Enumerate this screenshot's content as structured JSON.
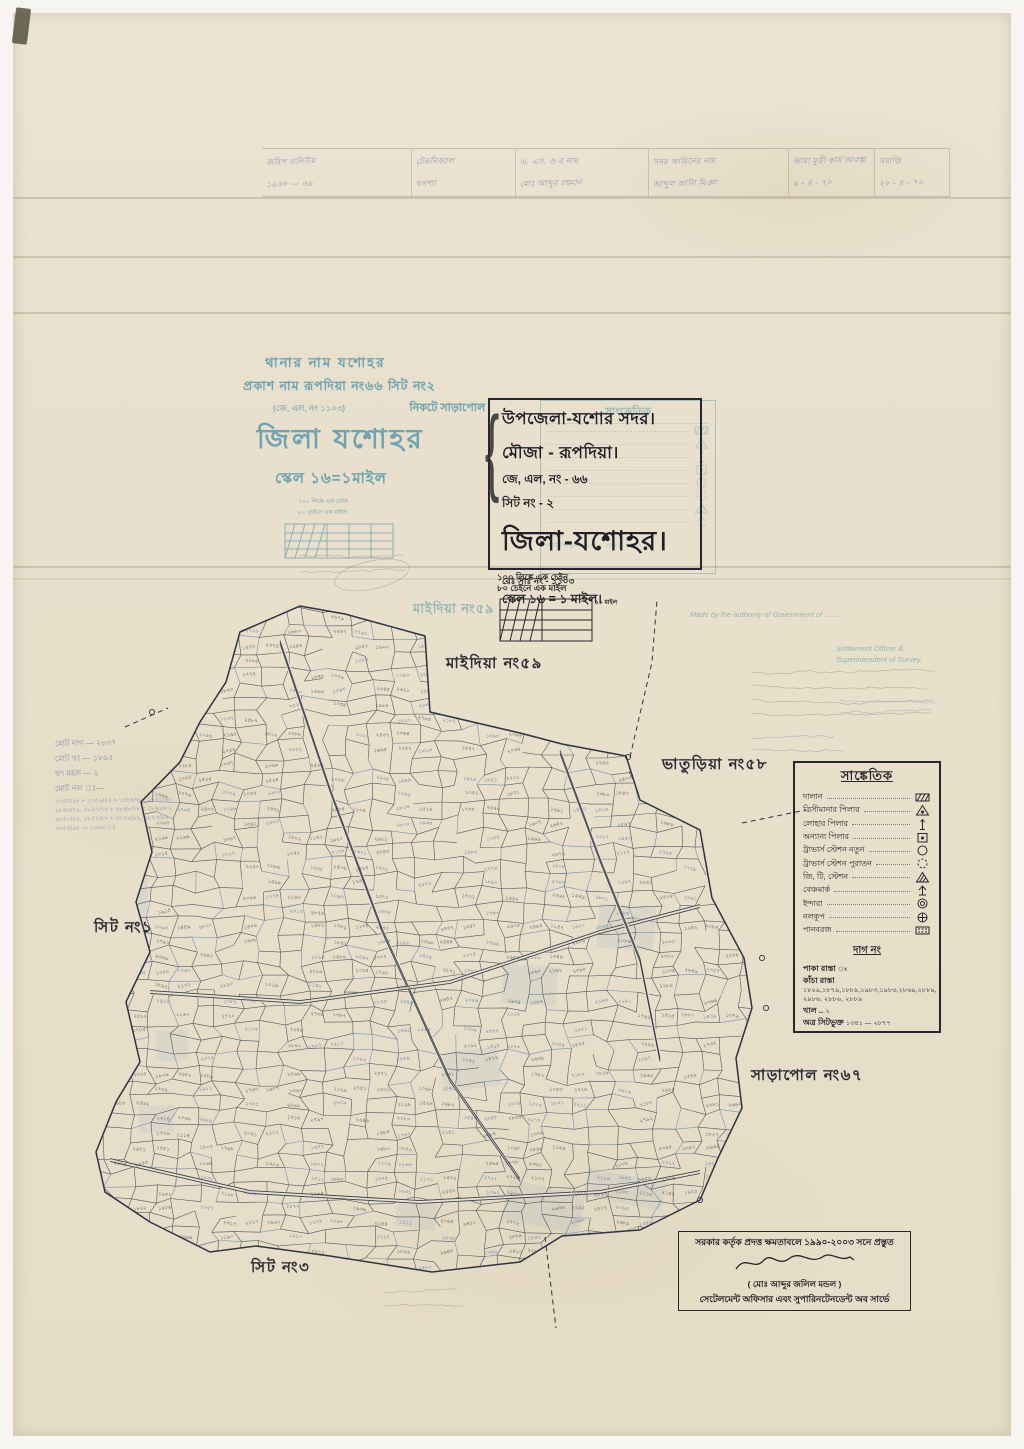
{
  "colors": {
    "paper": "#e9e1cd",
    "ink": "#26262c",
    "stamp_teal": "#4e93aa",
    "hand_blue": "#4a62a8",
    "map_ink": "#39404f",
    "map_blue": "#4a6fae"
  },
  "header_table": {
    "columns": [
      {
        "lines": [
          "জরিপ ভলিউম",
          "১৯৬৮ — ৬৯"
        ]
      },
      {
        "lines": [
          "টেকনিক্যাল",
          "ঘনশ্যা"
        ]
      },
      {
        "lines": [
          "এ. এস. ও-র নাম",
          "মোঃ আব্দুর রহমান"
        ]
      },
      {
        "lines": [
          "সদর আমিনের নাম",
          "আব্দুল আলি মিঞা"
        ]
      },
      {
        "lines": [
          "আমা মুড়ী কার্য আরম্ভ",
          "৯ - ৪ - ৭০"
        ]
      },
      {
        "lines": [
          "সমাপ্তি",
          "২৮ - ৪ - ৭০"
        ]
      }
    ]
  },
  "blue_stamp": {
    "line1": "থানার নাম যশোহর",
    "line2": "প্রকাশ নাম রূপদিয়া নং৬৬ সিট নং২",
    "line3a": "(জে, এল, নং ১১০৩)",
    "line3b": "নিকটে সাড়াপোল",
    "title": "জিলা যশোহর",
    "scale": "স্কেল ১৬=১মাইল",
    "note1": "১০০ লিঙ্কে এক চেইন",
    "note2": "৮০ চেইনে এক মাইল"
  },
  "ghost_legend": {
    "title": "সাংকেতিক",
    "foot1": "দাগ নং",
    "foot2": "অত্র সিটভুক্ত ১৩৪১ - ২৮৪১, ২৮৪২"
  },
  "title_block": {
    "upazila": "উপজেলা-যশোর সদর।",
    "mouza": "মৌজা - রূপদিয়া।",
    "jl_no": "জে, এল, নং - ৬৬",
    "sheet_no": "সিট নং - ২",
    "district": "জিলা-যশোহর।",
    "reg_no": "রেঃ সাঃ নং - ১১০৩",
    "scale": "স্কেল ১৬ = ১ মাইল।",
    "brace": "{"
  },
  "scale_note": {
    "line1": "১০০ লিঙ্কে এক চেইন",
    "line2": "৮০ চেইনে এক মাইল",
    "right_label": "১০ মাইল"
  },
  "map_labels": [
    {
      "text": "মাইদিয়া নং৫৯",
      "x": 413,
      "y": 600,
      "style": "blue"
    },
    {
      "text": "মাইদিয়া নং৫৯",
      "x": 446,
      "y": 652,
      "style": "black"
    },
    {
      "text": "ভাতুড়িয়া নং৫৮",
      "x": 662,
      "y": 753,
      "style": "black"
    },
    {
      "text": "সিট নং১",
      "x": 94,
      "y": 916,
      "style": "black"
    },
    {
      "text": "সাড়াপোল নং৬৭",
      "x": 751,
      "y": 1064,
      "style": "black"
    },
    {
      "text": "সিট নং৩",
      "x": 251,
      "y": 1256,
      "style": "black"
    }
  ],
  "legend": {
    "title": "সাঙ্কেতিক",
    "items": [
      {
        "label": "দালান",
        "symbol": "building"
      },
      {
        "label": "ত্রিসীমানার পিলার",
        "symbol": "triangle-dot"
      },
      {
        "label": "লোহার পিলার",
        "symbol": "iron-pillar"
      },
      {
        "label": "অন্যান্য পিলার",
        "symbol": "square-dot"
      },
      {
        "label": "ট্রাভার্স স্টেশন নতুন",
        "symbol": "circle"
      },
      {
        "label": "ট্রাভার্স স্টেশন পুরাতন",
        "symbol": "dashed-circle"
      },
      {
        "label": "জি, টি, স্টেশন",
        "symbol": "hatched-triangle"
      },
      {
        "label": "বেঞ্চমার্ক",
        "symbol": "benchmark"
      },
      {
        "label": "ইন্দারা",
        "symbol": "double-circle"
      },
      {
        "label": "নলকূপ",
        "symbol": "circle-cross"
      },
      {
        "label": "পানবরজ",
        "symbol": "pan-borj"
      }
    ]
  },
  "plot_section": {
    "header": "দাগ নং",
    "rows": [
      {
        "label": "পাকা রাস্তা",
        "value": "ঃ"
      },
      {
        "label": "কাঁচা রাস্তা",
        "value": "১৮০৯,১৮৭৯,১৮৮৯,১৯৮৩,১৯৮৬,২৮৬৯,২৮৮৯, ২৯৮৬, ২৮৮৬, ২৮৮৯"
      },
      {
        "label": "খাল ..",
        "value": "২"
      },
      {
        "label": "অত্র সিটভুক্ত",
        "value": "১৩৪১ — ২৮৭৭"
      }
    ],
    "bata_label": "বাটা দাগ ঃ",
    "bata_numbers": "১৩৪৫/২৮৪২, ১৩৫৭/২৮৪৩, ১৩৬৯/২৮৪৪, ১৩৭৫/২৮৪৫, ১৪৮৩/২৮৪৬, ১৫৯৭/২৮৪৭, ১৬০৫/২৮৪৮, ১৬৪৯/২৮৪৯, ১৭৫৩/২৮৫০, ১৭৬৯/২৮৫১, ১৮৪৫/২৮৫২, ১৮৯৩/২৮৫৩, ১৯৪৭/২৮৫৪, ১৯৬৫/২৮৫৫, ২০৪৩/২৮৫৬, ২১৪৫/২৮৫৭, ২২৬৩/২৮৫৮, ২৩৪৯/২৮৫৯, ২৪৫৩/২৮৬০, ২৫৪৭/২৮৬১, ২৬৪৫/২৮৬২, ২৭৪৯/২৮৬৩ ঃ"
  },
  "signature_block": {
    "line1": "সরকার কর্তৃক প্রদত্ত ক্ষমতাবলে ১৯৯০-২০০৩ সনে প্রস্তুত",
    "name": "( মোঃ আব্দুর জলিল মন্ডল )",
    "line3": "সেটেলমেন্ট অফিসার এবং সুপারিনটেনডেন্ট অব সার্ভে"
  },
  "english_stamps": {
    "line1": "Made by the authority of Government of ........",
    "line2": "Settlement Officer &",
    "line3": "Superintendent of Survey"
  },
  "side_notes": {
    "lines": [
      "মোট দাগ — ২৮৩৭",
      "মোট খং — ১৮৯৫",
      "হুদ মহল — ২",
      "মোট নল ঃ—"
    ],
    "fractions": [
      "১৩৪৫/২৮ + ১৩৫৬/৪২ = ১৩৮৮/৬৫, ২৮৪৫/৬৮",
      "২৮৪৬/৭২, ২৮৪৭/৭৫ + ২৮৪৮/৭৮ = ২৮৪৯/৮২",
      "২৮৫০/৮৫, ২৮৫১/৮৮ + ২৮৫২/৯২, ২৮৫৩/৯৫",
      "২৮৫৪/৯৮ — ১০৬৬ ঃ"
    ]
  },
  "map": {
    "x0": 86,
    "y0": 594,
    "x1": 766,
    "y1": 1274,
    "cols": 31,
    "rows": 46,
    "number_min": 1000,
    "number_max": 2890,
    "boundary": [
      [
        240,
        632
      ],
      [
        300,
        606
      ],
      [
        345,
        614
      ],
      [
        425,
        636
      ],
      [
        430,
        712
      ],
      [
        520,
        733
      ],
      [
        562,
        744
      ],
      [
        626,
        756
      ],
      [
        640,
        800
      ],
      [
        700,
        830
      ],
      [
        712,
        898
      ],
      [
        744,
        958
      ],
      [
        752,
        1008
      ],
      [
        736,
        1058
      ],
      [
        742,
        1108
      ],
      [
        718,
        1158
      ],
      [
        700,
        1200
      ],
      [
        640,
        1230
      ],
      [
        562,
        1236
      ],
      [
        520,
        1262
      ],
      [
        432,
        1272
      ],
      [
        330,
        1256
      ],
      [
        256,
        1246
      ],
      [
        210,
        1252
      ],
      [
        150,
        1222
      ],
      [
        105,
        1192
      ],
      [
        96,
        1152
      ],
      [
        116,
        1102
      ],
      [
        140,
        1062
      ],
      [
        126,
        1002
      ],
      [
        150,
        952
      ],
      [
        136,
        902
      ],
      [
        152,
        852
      ],
      [
        141,
        802
      ],
      [
        180,
        762
      ],
      [
        200,
        722
      ],
      [
        226,
        682
      ]
    ],
    "roads": [
      [
        [
          280,
          642
        ],
        [
          330,
          790
        ],
        [
          382,
          930
        ],
        [
          450,
          1080
        ],
        [
          520,
          1180
        ]
      ],
      [
        [
          110,
          1160
        ],
        [
          250,
          1192
        ],
        [
          420,
          1202
        ],
        [
          600,
          1192
        ],
        [
          700,
          1172
        ]
      ],
      [
        [
          150,
          992
        ],
        [
          300,
          1002
        ],
        [
          450,
          982
        ],
        [
          600,
          932
        ],
        [
          700,
          906
        ]
      ],
      [
        [
          560,
          752
        ],
        [
          600,
          860
        ],
        [
          640,
          960
        ],
        [
          660,
          1060
        ]
      ]
    ],
    "dashed": [
      [
        [
          630,
          757
        ],
        [
          652,
          662
        ],
        [
          657,
          600
        ]
      ],
      [
        [
          545,
          1237
        ],
        [
          556,
          1328
        ]
      ],
      [
        [
          125,
          727
        ],
        [
          168,
          708
        ]
      ],
      [
        [
          742,
          823
        ],
        [
          806,
          810
        ]
      ]
    ],
    "stations": [
      [
        152,
        712
      ],
      [
        762,
        958
      ],
      [
        766,
        1008
      ],
      [
        628,
        757
      ],
      [
        700,
        1200
      ]
    ]
  }
}
